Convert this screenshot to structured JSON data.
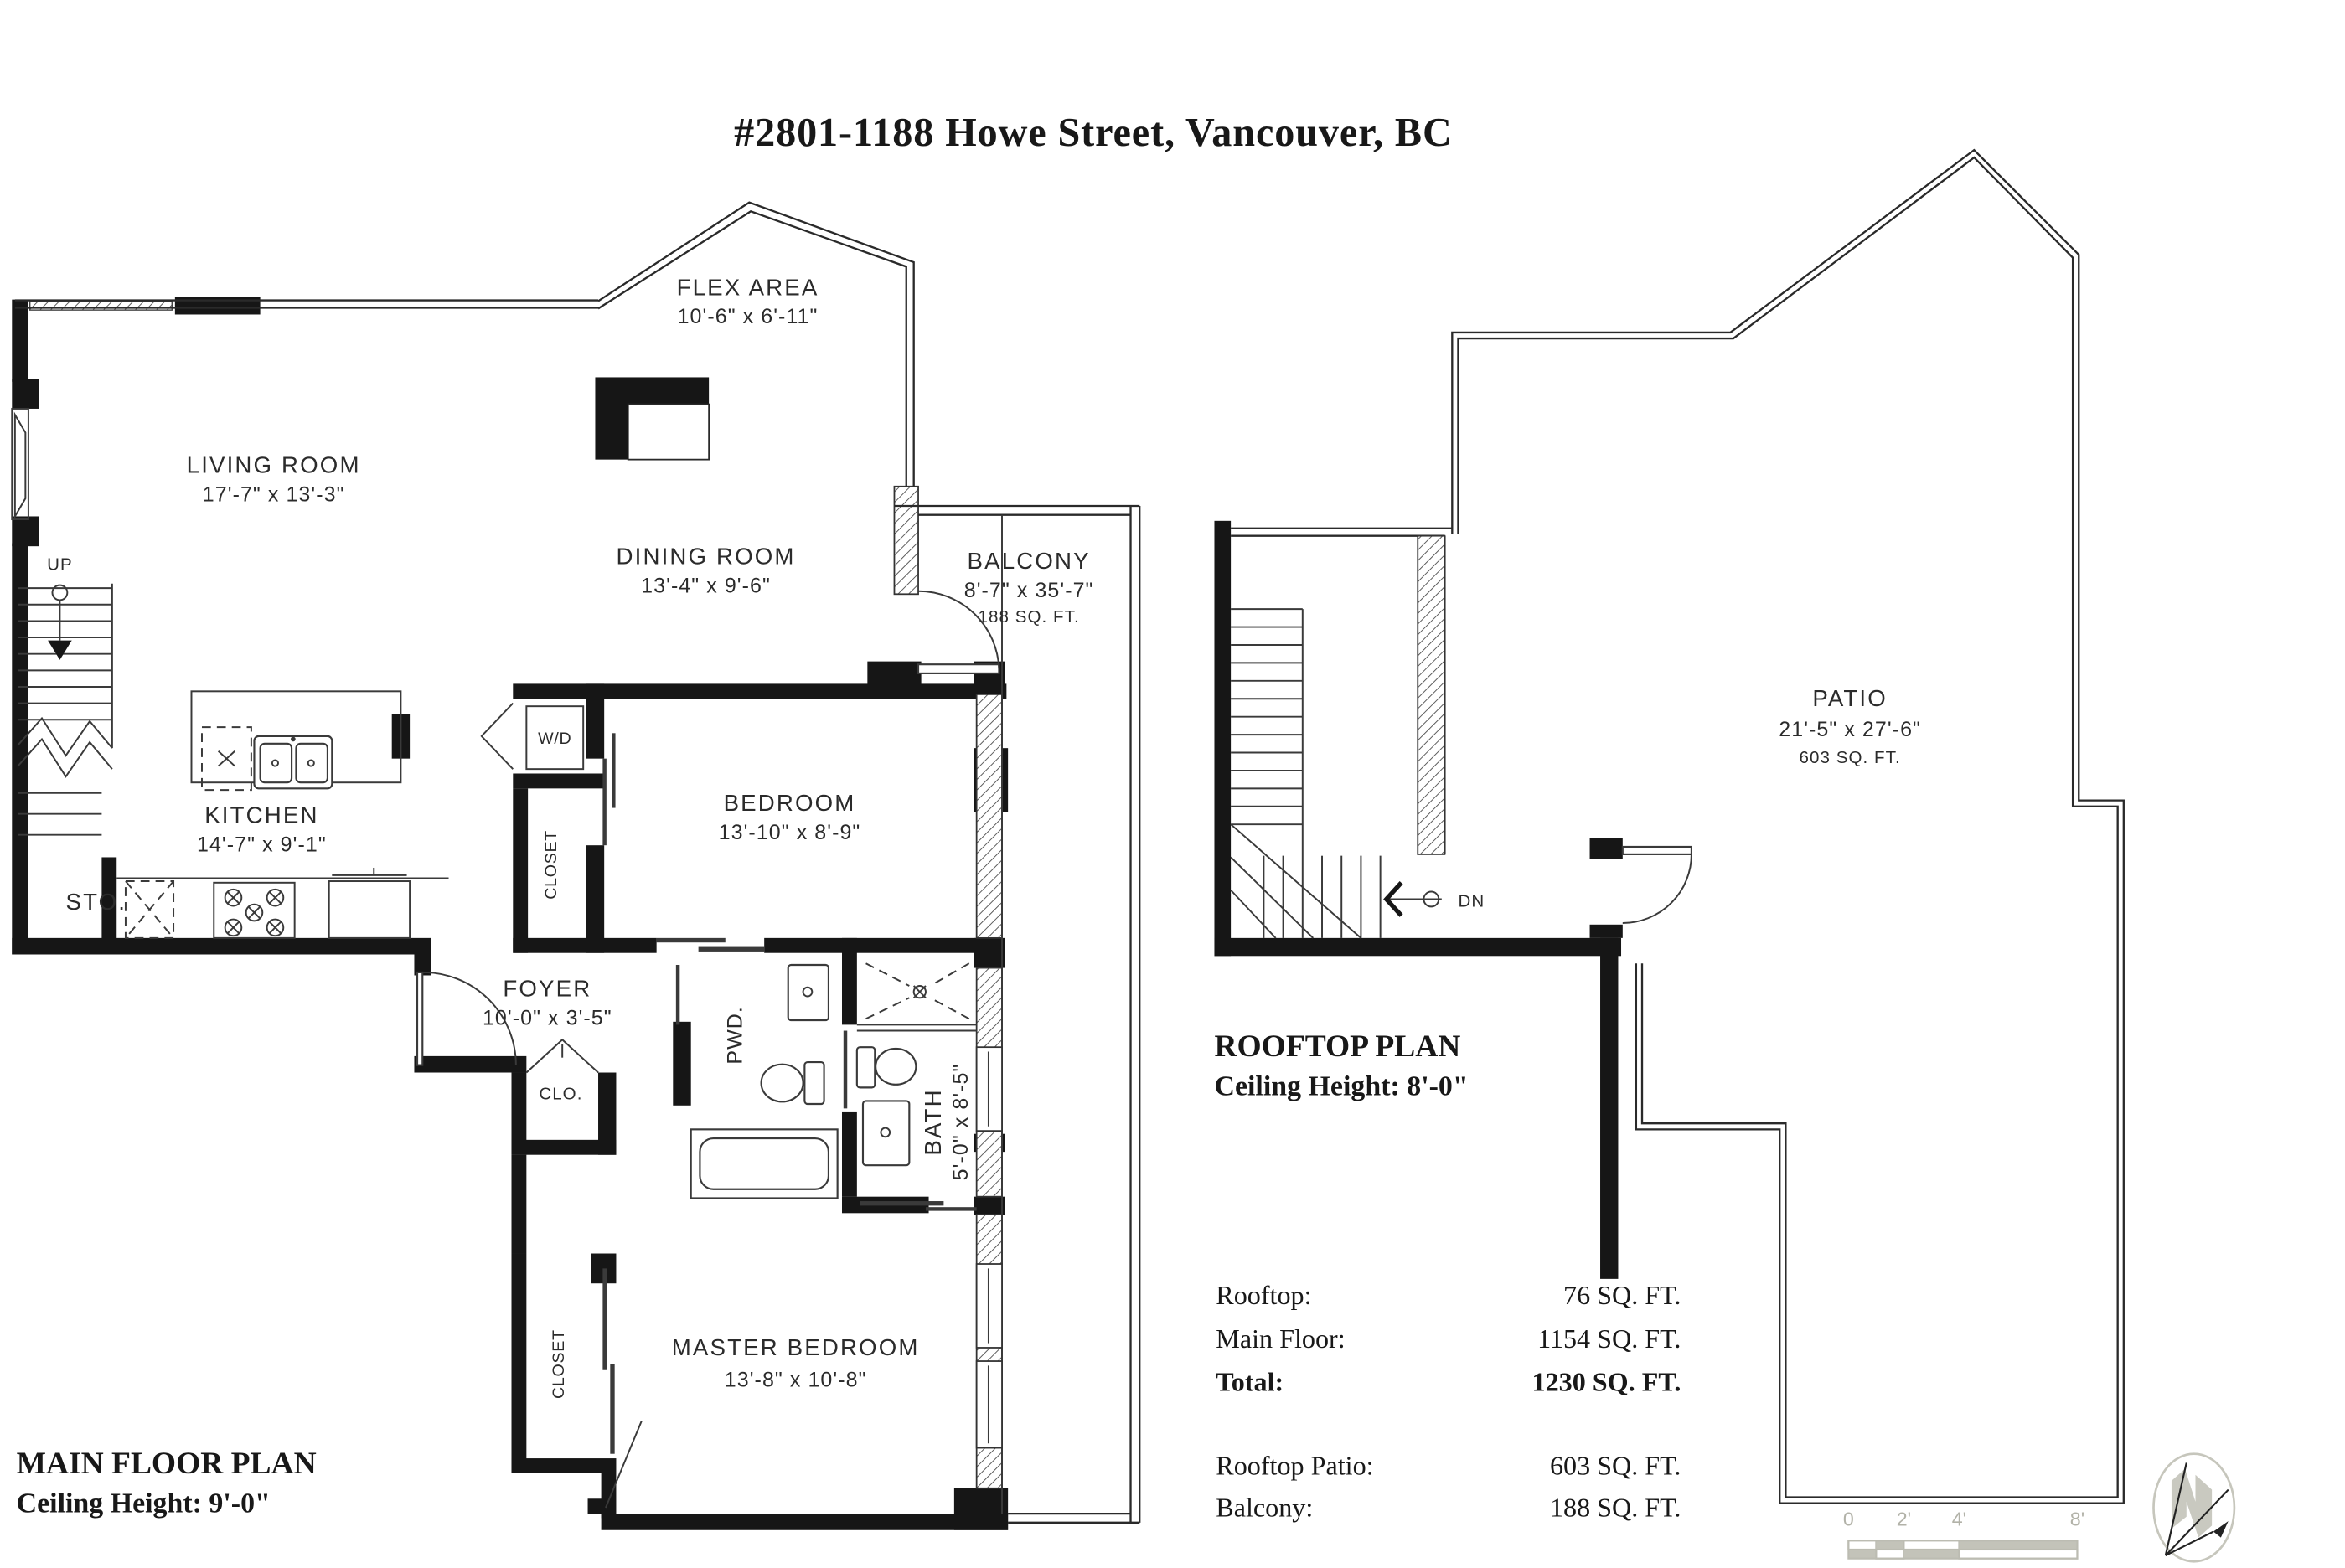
{
  "title": "#2801-1188 Howe Street, Vancouver, BC",
  "main_plan": {
    "name": "MAIN FLOOR PLAN",
    "ceiling": "Ceiling Height: 9'-0\"",
    "rooms": {
      "living": {
        "name": "LIVING ROOM",
        "dims": "17'-7\" x 13'-3\""
      },
      "flex": {
        "name": "FLEX AREA",
        "dims": "10'-6\" x 6'-11\""
      },
      "dining": {
        "name": "DINING ROOM",
        "dims": "13'-4\" x 9'-6\""
      },
      "balcony": {
        "name": "BALCONY",
        "dims": "8'-7\" x 35'-7\"",
        "area": "188 SQ. FT."
      },
      "kitchen": {
        "name": "KITCHEN",
        "dims": "14'-7\" x 9'-1\""
      },
      "bedroom": {
        "name": "BEDROOM",
        "dims": "13'-10\" x 8'-9\""
      },
      "foyer": {
        "name": "FOYER",
        "dims": "10'-0\" x 3'-5\""
      },
      "bath": {
        "name": "BATH",
        "dims": "5'-0\" x 8'-5\""
      },
      "master": {
        "name": "MASTER BEDROOM",
        "dims": "13'-8\" x 10'-8\""
      },
      "pwd": "PWD.",
      "sto": "STO.",
      "clo": "CLO.",
      "wd": "W/D",
      "closet": "CLOSET",
      "up": "UP"
    }
  },
  "rooftop_plan": {
    "name": "ROOFTOP PLAN",
    "ceiling": "Ceiling Height: 8'-0\"",
    "patio": {
      "name": "PATIO",
      "dims": "21'-5\" x 27'-6\"",
      "area": "603 SQ. FT."
    },
    "dn": "DN"
  },
  "area_table": {
    "rows": [
      {
        "label": "Rooftop:",
        "value": "76 SQ. FT."
      },
      {
        "label": "Main Floor:",
        "value": "1154 SQ. FT."
      },
      {
        "label": "Total:",
        "value": "1230 SQ. FT."
      },
      {
        "label": "Rooftop Patio:",
        "value": "603 SQ. FT."
      },
      {
        "label": "Balcony:",
        "value": "188 SQ. FT."
      }
    ]
  },
  "scale_bar": {
    "ticks": [
      "0",
      "2'",
      "4'",
      "8'"
    ]
  },
  "colors": {
    "wall": "#161616",
    "line": "#2a2a2a",
    "scale_muted": "#b2b2a8"
  }
}
